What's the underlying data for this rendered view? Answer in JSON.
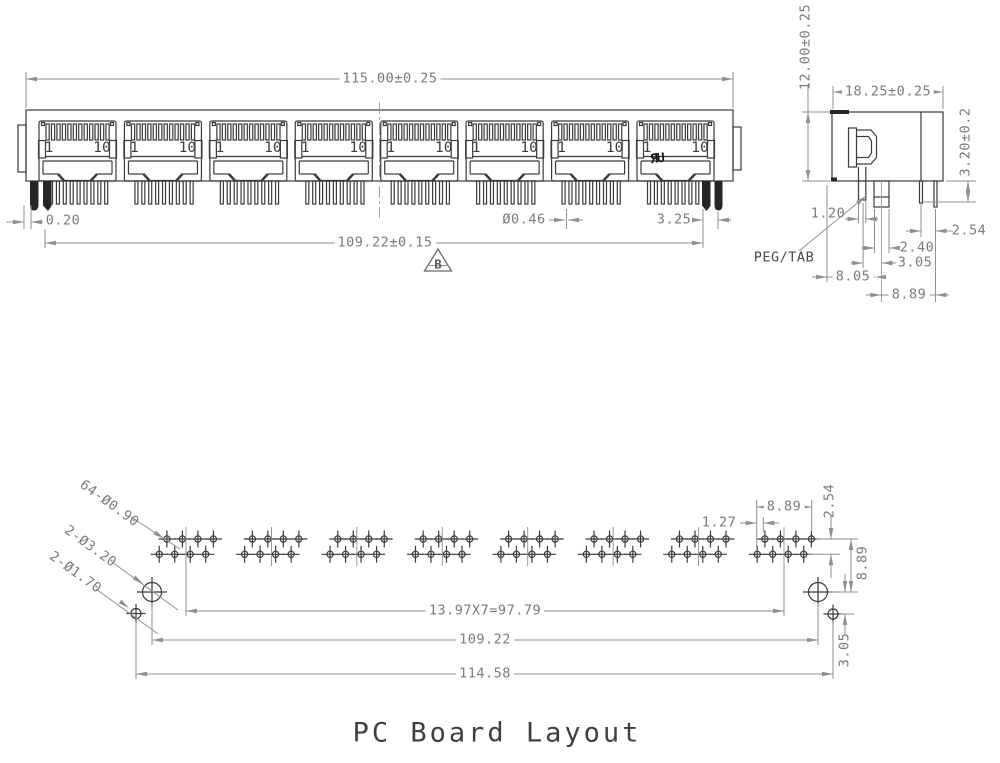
{
  "title": "PC Board Layout",
  "front_view": {
    "dim_width": "115.00±0.25",
    "dim_pin_span": "109.22±0.15",
    "dim_shield_offset": "0.20",
    "dim_pin_diameter": "Ø0.46",
    "dim_peg_offset": "3.25",
    "revision_marker": "B",
    "ul_mark": "ЯU",
    "ports": [
      {
        "left": "1",
        "right": "10"
      },
      {
        "left": "1",
        "right": "10"
      },
      {
        "left": "1",
        "right": "10"
      },
      {
        "left": "1",
        "right": "10"
      },
      {
        "left": "1",
        "right": "10"
      },
      {
        "left": "1",
        "right": "10"
      },
      {
        "left": "1",
        "right": "10"
      },
      {
        "left": "1",
        "right": "10"
      }
    ]
  },
  "side_view": {
    "dim_height": "12.00±0.25",
    "dim_depth": "18.25±0.25",
    "dim_pin_length": "3.20±0.2",
    "dim_shield_pin_width": "1.20",
    "dim_pin_pitch": "2.54",
    "dim_peg_width": "2.40",
    "dim_pin_to_peg": "3.05",
    "dim_front_to_peg": "8.05",
    "dim_peg_to_pin": "8.89",
    "peg_label": "PEG/TAB"
  },
  "board_layout": {
    "callout_pin_holes": "64-Ø0.90",
    "callout_peg_holes": "2-Ø3.20",
    "callout_mount_holes": "2-Ø1.70",
    "dim_stagger": "1.27",
    "dim_group_span": "8.89",
    "dim_row_pitch": "2.54",
    "dim_row_to_peg_hole": "8.89",
    "dim_peg_to_mount_hole": "3.05",
    "dim_pitch_equation": "13.97X7=97.79",
    "dim_peg_hole_span": "109.22",
    "dim_mount_hole_span": "114.58"
  },
  "colors": {
    "geometry": "#3a3a3a",
    "dimension": "#8f8f8f",
    "text": "#7a7a7a"
  }
}
